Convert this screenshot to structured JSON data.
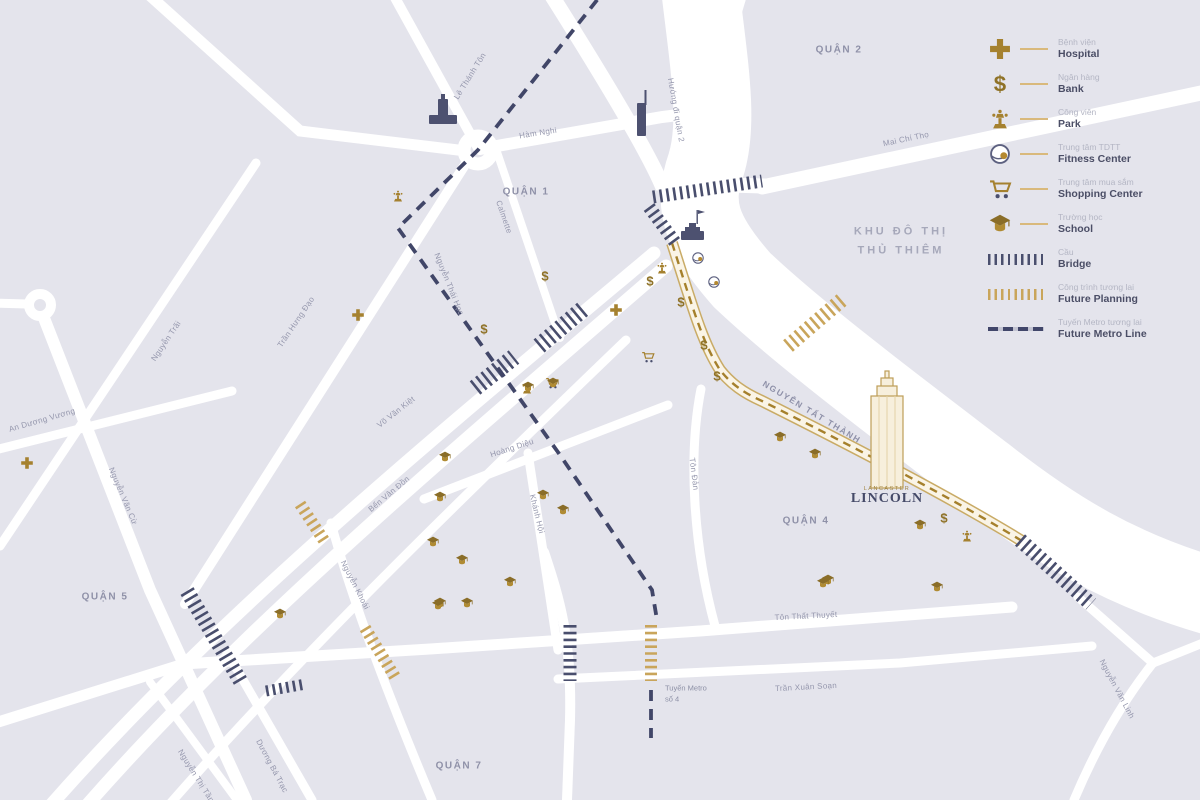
{
  "map": {
    "background_color": "#e4e4ec",
    "road_color": "#ffffff",
    "accent_gold": "#a5812f",
    "metro_navy": "#41466a",
    "districts": [
      {
        "label": "QUẬN 2",
        "x": 839,
        "y": 50
      },
      {
        "label": "QUẬN 1",
        "x": 526,
        "y": 192
      },
      {
        "label": "QUẬN 4",
        "x": 806,
        "y": 521
      },
      {
        "label": "QUẬN 5",
        "x": 105,
        "y": 597
      },
      {
        "label": "QUẬN 7",
        "x": 459,
        "y": 766
      }
    ],
    "area_label": {
      "line1": "KHU ĐÔ THỊ",
      "line2": "THỦ THIÊM",
      "x": 901,
      "y": 241
    },
    "streets": [
      {
        "label": "Lê Thánh Tôn",
        "x": 470,
        "y": 76,
        "rot": -58
      },
      {
        "label": "Hàm Nghi",
        "x": 538,
        "y": 133,
        "rot": -9
      },
      {
        "label": "Hướng đi quận 2",
        "x": 676,
        "y": 110,
        "rot": 80
      },
      {
        "label": "Mai Chí Thọ",
        "x": 906,
        "y": 139,
        "rot": -12
      },
      {
        "label": "Calmette",
        "x": 504,
        "y": 217,
        "rot": 71
      },
      {
        "label": "Nguyễn Thái Học",
        "x": 449,
        "y": 284,
        "rot": 68
      },
      {
        "label": "Trần Hưng Đạo",
        "x": 296,
        "y": 322,
        "rot": -56
      },
      {
        "label": "Nguyễn Trãi",
        "x": 166,
        "y": 341,
        "rot": -56
      },
      {
        "label": "An Dương Vương",
        "x": 42,
        "y": 420,
        "rot": -16
      },
      {
        "label": "Nguyễn Văn Cừ",
        "x": 123,
        "y": 496,
        "rot": 67
      },
      {
        "label": "Võ Văn Kiệt",
        "x": 396,
        "y": 412,
        "rot": -38
      },
      {
        "label": "Bến Vân Đồn",
        "x": 389,
        "y": 494,
        "rot": -40
      },
      {
        "label": "Hoàng Diệu",
        "x": 512,
        "y": 448,
        "rot": -18
      },
      {
        "label": "Khánh Hội",
        "x": 537,
        "y": 514,
        "rot": 76
      },
      {
        "label": "Nguyễn Khoái",
        "x": 355,
        "y": 585,
        "rot": 63
      },
      {
        "label": "Tôn Đản",
        "x": 694,
        "y": 474,
        "rot": 83
      },
      {
        "label": "NGUYỄN TẤT THÀNH",
        "x": 812,
        "y": 412,
        "rot": 31,
        "cls": "street-label-major"
      },
      {
        "label": "Tôn Thất Thuyết",
        "x": 806,
        "y": 616,
        "rot": -3
      },
      {
        "label": "Trần Xuân Soạn",
        "x": 806,
        "y": 687,
        "rot": -3
      },
      {
        "label": "Dương Bá Trạc",
        "x": 272,
        "y": 766,
        "rot": 62
      },
      {
        "label": "Nguyễn Thị Tần",
        "x": 196,
        "y": 776,
        "rot": 58
      },
      {
        "label": "Nguyễn Văn Linh",
        "x": 1117,
        "y": 689,
        "rot": 62
      }
    ],
    "metro_label": {
      "line1": "Tuyến Metro",
      "line2": "số 4",
      "x": 665,
      "y": 694
    },
    "markers": [
      {
        "type": "hospital",
        "x": 358,
        "y": 315
      },
      {
        "type": "hospital",
        "x": 616,
        "y": 310
      },
      {
        "type": "hospital",
        "x": 27,
        "y": 463
      },
      {
        "type": "bank",
        "x": 545,
        "y": 276
      },
      {
        "type": "bank",
        "x": 484,
        "y": 329
      },
      {
        "type": "bank",
        "x": 650,
        "y": 281
      },
      {
        "type": "bank",
        "x": 681,
        "y": 302
      },
      {
        "type": "bank",
        "x": 704,
        "y": 345
      },
      {
        "type": "bank",
        "x": 717,
        "y": 376
      },
      {
        "type": "bank",
        "x": 944,
        "y": 518
      },
      {
        "type": "park",
        "x": 398,
        "y": 196
      },
      {
        "type": "park",
        "x": 662,
        "y": 268
      },
      {
        "type": "park",
        "x": 527,
        "y": 388
      },
      {
        "type": "park",
        "x": 967,
        "y": 536
      },
      {
        "type": "fitness",
        "x": 698,
        "y": 258
      },
      {
        "type": "fitness",
        "x": 714,
        "y": 282
      },
      {
        "type": "cart",
        "x": 648,
        "y": 357
      },
      {
        "type": "cart",
        "x": 552,
        "y": 383
      },
      {
        "type": "school",
        "x": 528,
        "y": 387
      },
      {
        "type": "school",
        "x": 553,
        "y": 383
      },
      {
        "type": "school",
        "x": 445,
        "y": 457
      },
      {
        "type": "school",
        "x": 440,
        "y": 497
      },
      {
        "type": "school",
        "x": 433,
        "y": 542
      },
      {
        "type": "school",
        "x": 462,
        "y": 560
      },
      {
        "type": "school",
        "x": 510,
        "y": 582
      },
      {
        "type": "school",
        "x": 440,
        "y": 603
      },
      {
        "type": "school",
        "x": 467,
        "y": 603
      },
      {
        "type": "school",
        "x": 543,
        "y": 495
      },
      {
        "type": "school",
        "x": 563,
        "y": 510
      },
      {
        "type": "school",
        "x": 780,
        "y": 437
      },
      {
        "type": "school",
        "x": 815,
        "y": 454
      },
      {
        "type": "school",
        "x": 828,
        "y": 580
      },
      {
        "type": "school",
        "x": 920,
        "y": 525
      },
      {
        "type": "school",
        "x": 937,
        "y": 587
      },
      {
        "type": "school",
        "x": 823,
        "y": 583
      },
      {
        "type": "school",
        "x": 280,
        "y": 614
      },
      {
        "type": "school",
        "x": 438,
        "y": 605
      }
    ],
    "landmark": {
      "brand": "LANCASTER",
      "name": "LINCOLN",
      "x": 887,
      "y": 495
    }
  },
  "legend": {
    "items": [
      {
        "icon": "hospital",
        "vi": "Bệnh viện",
        "en": "Hospital"
      },
      {
        "icon": "bank",
        "vi": "Ngân hàng",
        "en": "Bank"
      },
      {
        "icon": "park",
        "vi": "Công viên",
        "en": "Park"
      },
      {
        "icon": "fitness",
        "vi": "Trung tâm TDTT",
        "en": "Fitness Center"
      },
      {
        "icon": "cart",
        "vi": "Trung tâm mua sắm",
        "en": "Shopping Center"
      },
      {
        "icon": "school",
        "vi": "Trường học",
        "en": "School"
      },
      {
        "icon": "hatch-dark",
        "vi": "Cầu",
        "en": "Bridge"
      },
      {
        "icon": "hatch-gold",
        "vi": "Công trình tương lai",
        "en": "Future Planning"
      },
      {
        "icon": "metro",
        "vi": "Tuyến Metro tương lai",
        "en": "Future Metro Line"
      }
    ]
  }
}
